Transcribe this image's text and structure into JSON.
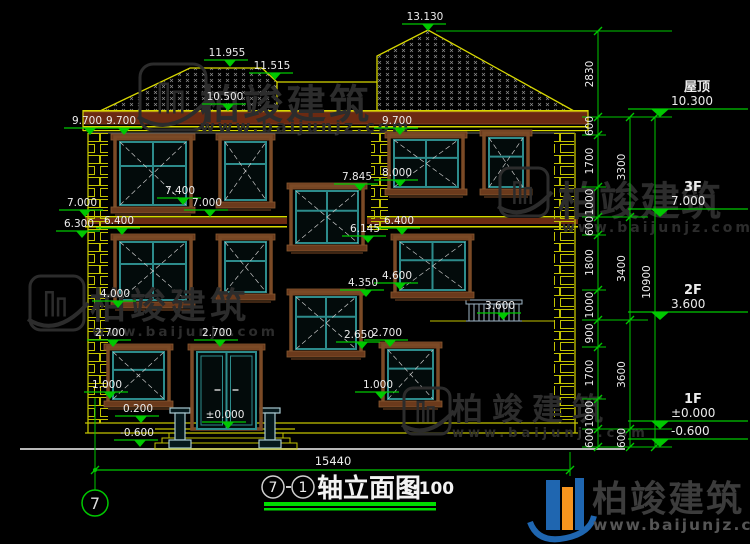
{
  "watermark": {
    "brand": "柏竣建筑",
    "url": "www.baijunjz.com"
  },
  "title": {
    "axis_from": "7",
    "axis_to": "1",
    "name": "轴立面图",
    "scale": "1:100"
  },
  "axis_bubble": "7",
  "bottom_dim": "15440",
  "levels": [
    {
      "label": "屋顶",
      "value": "10.300",
      "y": 117
    },
    {
      "label": "3F",
      "value": "7.000",
      "y": 217
    },
    {
      "label": "2F",
      "value": "3.600",
      "y": 320
    },
    {
      "label": "1F",
      "value": "±0.000",
      "y": 429
    },
    {
      "label": "",
      "value": "-0.600",
      "y": 447
    }
  ],
  "markers": [
    {
      "v": "13.130",
      "x": 428,
      "y": 31
    },
    {
      "v": "11.955",
      "x": 230,
      "y": 67
    },
    {
      "v": "11.515",
      "x": 275,
      "y": 80
    },
    {
      "v": "10.500",
      "x": 228,
      "y": 111
    },
    {
      "v": "9.700",
      "x": 90,
      "y": 135
    },
    {
      "v": "9.700",
      "x": 124,
      "y": 135
    },
    {
      "v": "9.700",
      "x": 400,
      "y": 135
    },
    {
      "v": "8.000",
      "x": 400,
      "y": 187
    },
    {
      "v": "7.845",
      "x": 360,
      "y": 191
    },
    {
      "v": "7.400",
      "x": 183,
      "y": 205
    },
    {
      "v": "7.000",
      "x": 85,
      "y": 217
    },
    {
      "v": "7.000",
      "x": 210,
      "y": 217
    },
    {
      "v": "6.400",
      "x": 122,
      "y": 235
    },
    {
      "v": "6.400",
      "x": 402,
      "y": 235
    },
    {
      "v": "6.300",
      "x": 82,
      "y": 238
    },
    {
      "v": "6.145",
      "x": 368,
      "y": 243
    },
    {
      "v": "4.600",
      "x": 400,
      "y": 290
    },
    {
      "v": "4.350",
      "x": 366,
      "y": 297
    },
    {
      "v": "4.000",
      "x": 118,
      "y": 308
    },
    {
      "v": "3.600",
      "x": 503,
      "y": 320
    },
    {
      "v": "2.700",
      "x": 113,
      "y": 347
    },
    {
      "v": "2.700",
      "x": 220,
      "y": 347
    },
    {
      "v": "2.650",
      "x": 362,
      "y": 349
    },
    {
      "v": "2.700",
      "x": 390,
      "y": 347
    },
    {
      "v": "1.000",
      "x": 110,
      "y": 399
    },
    {
      "v": "1.000",
      "x": 381,
      "y": 399
    },
    {
      "v": "0.200",
      "x": 141,
      "y": 423
    },
    {
      "v": "±0.000",
      "x": 228,
      "y": 429
    },
    {
      "v": "-0.600",
      "x": 140,
      "y": 447
    }
  ],
  "dim_chains": [
    {
      "x": 598,
      "segments": [
        {
          "v": "2830",
          "y1": 31,
          "y2": 117
        },
        {
          "v": "600",
          "y1": 117,
          "y2": 135
        },
        {
          "v": "1700",
          "y1": 135,
          "y2": 187
        },
        {
          "v": "1000",
          "y1": 187,
          "y2": 217
        },
        {
          "v": "600",
          "y1": 217,
          "y2": 235
        },
        {
          "v": "1800",
          "y1": 235,
          "y2": 290
        },
        {
          "v": "1000",
          "y1": 290,
          "y2": 320
        },
        {
          "v": "900",
          "y1": 320,
          "y2": 347
        },
        {
          "v": "1700",
          "y1": 347,
          "y2": 399
        },
        {
          "v": "1000",
          "y1": 399,
          "y2": 429
        },
        {
          "v": "600",
          "y1": 429,
          "y2": 447
        }
      ]
    },
    {
      "x": 630,
      "segments": [
        {
          "v": "3300",
          "y1": 117,
          "y2": 217
        },
        {
          "v": "3400",
          "y1": 217,
          "y2": 320
        },
        {
          "v": "3600",
          "y1": 320,
          "y2": 429
        },
        {
          "v": "600",
          "y1": 429,
          "y2": 447
        }
      ]
    },
    {
      "x": 655,
      "segments": [
        {
          "v": "10900",
          "y1": 117,
          "y2": 447
        }
      ]
    }
  ]
}
